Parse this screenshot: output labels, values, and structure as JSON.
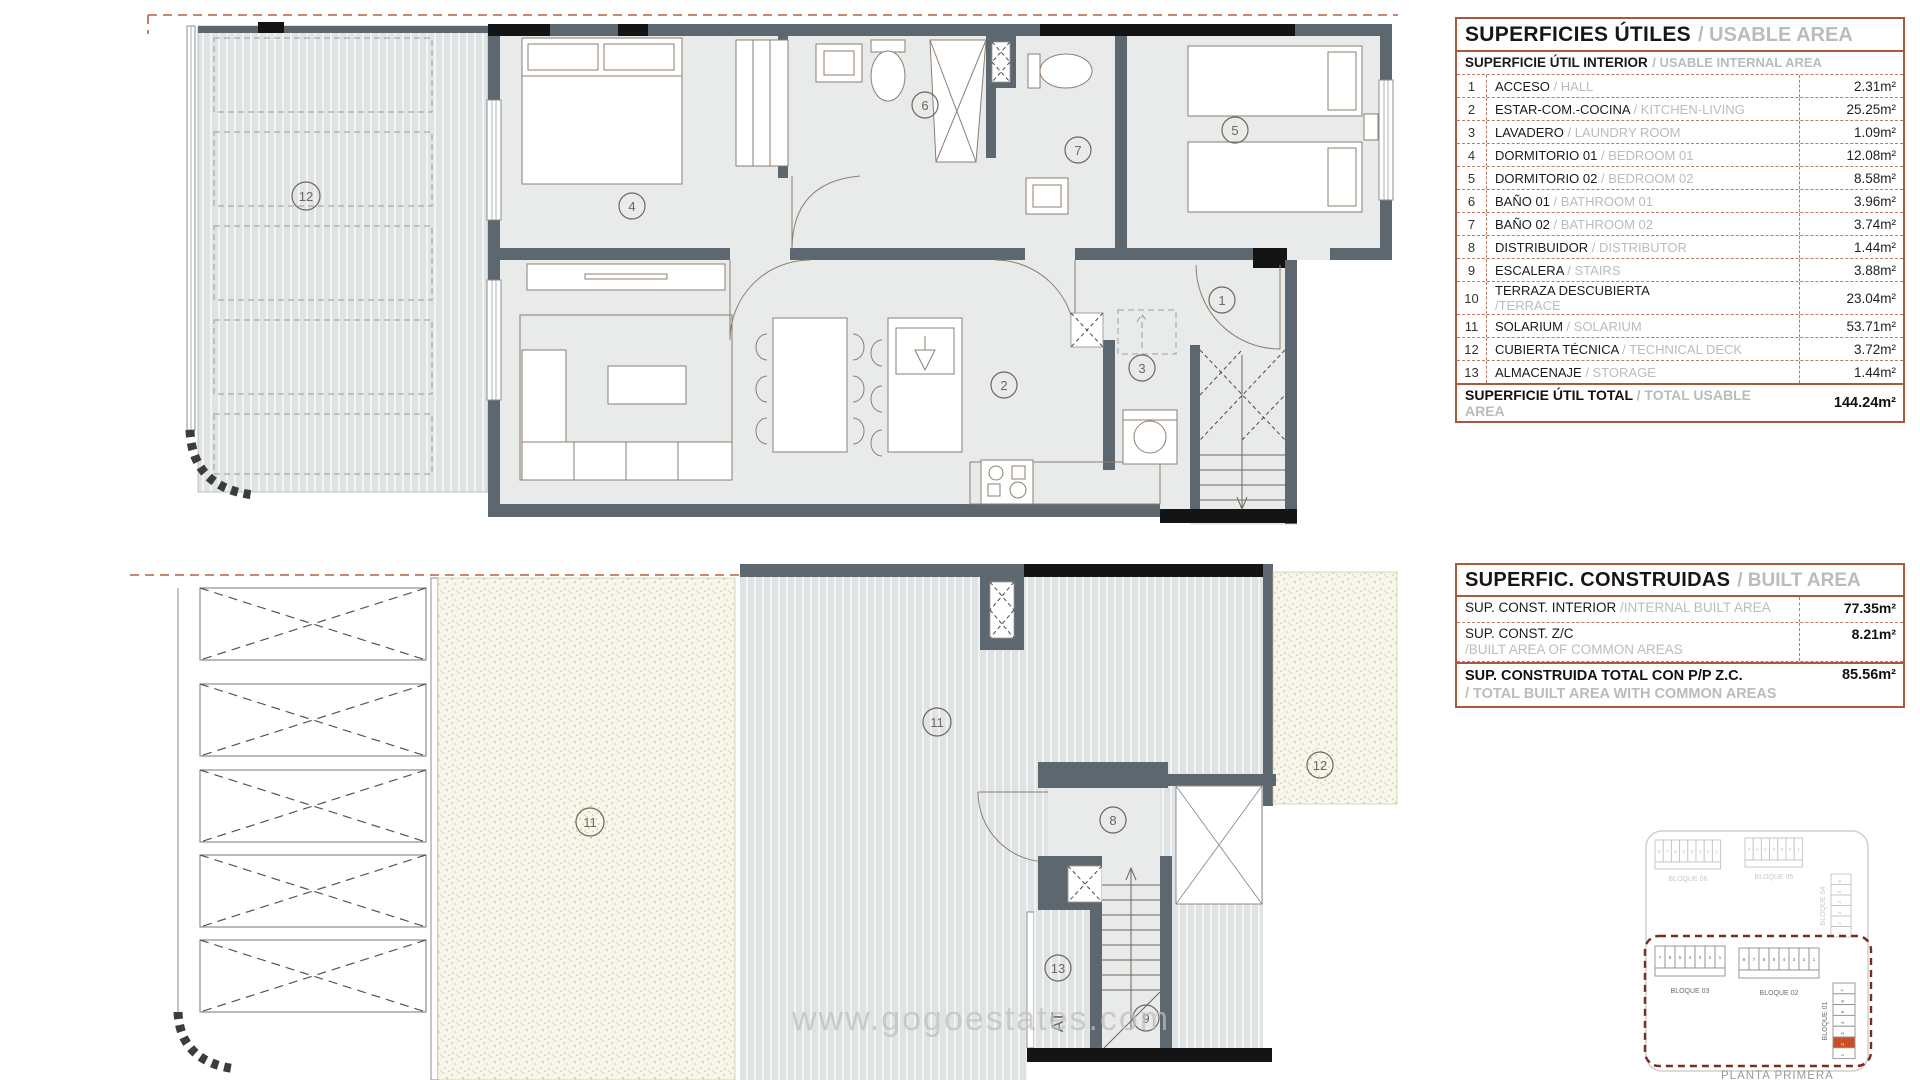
{
  "usable_area": {
    "title_es": "SUPERFICIES ÚTILES",
    "title_en": "/ USABLE AREA",
    "subtitle_es": "SUPERFICIE ÚTIL INTERIOR",
    "subtitle_en": "/ USABLE INTERNAL AREA",
    "rows": [
      {
        "num": "1",
        "es": "ACCESO",
        "en": "/ HALL",
        "value": "2.31m²"
      },
      {
        "num": "2",
        "es": "ESTAR-COM.-COCINA",
        "en": "/ KITCHEN-LIVING",
        "value": "25.25m²"
      },
      {
        "num": "3",
        "es": "LAVADERO",
        "en": "/ LAUNDRY ROOM",
        "value": "1.09m²"
      },
      {
        "num": "4",
        "es": "DORMITORIO 01",
        "en": "/ BEDROOM 01",
        "value": "12.08m²"
      },
      {
        "num": "5",
        "es": "DORMITORIO 02",
        "en": "/ BEDROOM 02",
        "value": "8.58m²"
      },
      {
        "num": "6",
        "es": "BAÑO 01",
        "en": "/ BATHROOM 01",
        "value": "3.96m²"
      },
      {
        "num": "7",
        "es": "BAÑO 02",
        "en": "/ BATHROOM 02",
        "value": "3.74m²"
      },
      {
        "num": "8",
        "es": "DISTRIBUIDOR",
        "en": "/ DISTRIBUTOR",
        "value": "1.44m²"
      },
      {
        "num": "9",
        "es": "ESCALERA",
        "en": "/ STAIRS",
        "value": "3.88m²"
      },
      {
        "num": "10",
        "es": "TERRAZA DESCUBIERTA",
        "en": "/TERRACE",
        "two_line": true,
        "value": "23.04m²"
      },
      {
        "num": "11",
        "es": "SOLARIUM",
        "en": "/ SOLARIUM",
        "value": "53.71m²"
      },
      {
        "num": "12",
        "es": "CUBIERTA TÉCNICA",
        "en": "/ TECHNICAL DECK",
        "value": "3.72m²"
      },
      {
        "num": "13",
        "es": "ALMACENAJE",
        "en": "/ STORAGE",
        "value": "1.44m²"
      }
    ],
    "total_es": "SUPERFICIE ÚTIL TOTAL",
    "total_en": "/ TOTAL USABLE AREA",
    "total_value": "144.24m²"
  },
  "built_area": {
    "title_es": "SUPERFIC. CONSTRUIDAS",
    "title_en": "/ BUILT AREA",
    "rows": [
      {
        "es": "SUP. CONST. INTERIOR",
        "en": "/INTERNAL BUILT AREA",
        "inline": true,
        "value": "77.35m²"
      },
      {
        "es": "SUP. CONST. Z/C",
        "en": "/BUILT AREA OF COMMON AREAS",
        "inline": false,
        "value": "8.21m²"
      }
    ],
    "total_es": "SUP. CONSTRUIDA TOTAL CON P/P Z.C.",
    "total_en": "/ TOTAL BUILT AREA WITH COMMON AREAS",
    "total_value": "85.56m²"
  },
  "plans": {
    "top": {
      "labels": [
        "12",
        "4",
        "6",
        "7",
        "5",
        "1",
        "2",
        "3"
      ]
    },
    "bottom": {
      "labels": [
        "11",
        "11",
        "12",
        "8",
        "13",
        "9"
      ],
      "storage_text": "AT"
    }
  },
  "siteplan": {
    "caption": "PLANTA PRIMERA",
    "blocks": [
      {
        "label": "BLOQUE 06",
        "units": [
          "8",
          "7",
          "6",
          "5",
          "4",
          "3",
          "2",
          "1"
        ],
        "dim": true
      },
      {
        "label": "BLOQUE 05",
        "units": [
          "7",
          "6",
          "5",
          "4",
          "3",
          "2",
          "1"
        ],
        "dim": true
      },
      {
        "label": "BLOQUE 04",
        "units": [
          "6",
          "5",
          "4",
          "3",
          "2",
          "1"
        ],
        "dim": true
      },
      {
        "label": "BLOQUE 03",
        "units": [
          "7",
          "6",
          "5",
          "4",
          "3",
          "2",
          "1"
        ],
        "dim": false
      },
      {
        "label": "BLOQUE 02",
        "units": [
          "8",
          "7",
          "6",
          "5",
          "4",
          "3",
          "2",
          "1"
        ],
        "dim": false
      },
      {
        "label": "BLOQUE 01",
        "units": [
          "7",
          "6",
          "5",
          "4",
          "3",
          "2",
          "1"
        ],
        "dim": false,
        "highlighted": "2"
      }
    ],
    "highlight_color": "#c94f24"
  },
  "watermark": "www.gogoestates.com"
}
